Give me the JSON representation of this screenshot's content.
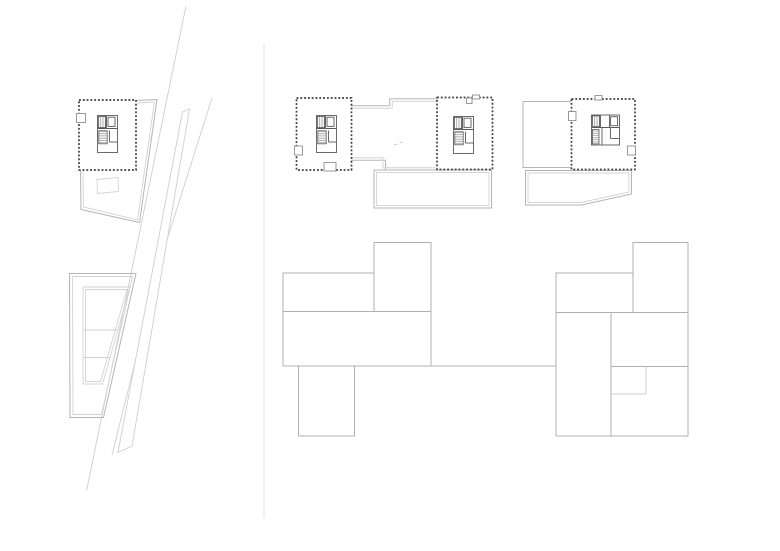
{
  "colors": {
    "background": "#ffffff",
    "wall": "#3f3f3f",
    "core": "#5a5a5a",
    "hatch": "#8a8a8a",
    "outline": "#b5b5b5",
    "outline_light": "#d3d3d3",
    "massing": "#b0b0b0",
    "massing_light": "#cccccc",
    "faint": "#cfcfcf",
    "divider": "#e3e3e3",
    "door": "#8f8f8f"
  },
  "massing": {
    "left_block_plan": {
      "rects": [
        {
          "x": 374,
          "y": 242.5,
          "w": 57,
          "h": 69,
          "name": "block-top-right"
        },
        {
          "x": 283,
          "y": 273,
          "w": 91,
          "h": 38.5,
          "name": "block-upper-left"
        },
        {
          "x": 283,
          "y": 311.5,
          "w": 148,
          "h": 54.5,
          "name": "block-middle-bar"
        },
        {
          "x": 298.5,
          "y": 366,
          "w": 56,
          "h": 70,
          "name": "block-bottom-wing"
        }
      ],
      "lines": [
        {
          "x1": 431,
          "y1": 366,
          "x2": 556,
          "y2": 366,
          "name": "link-line"
        }
      ]
    },
    "right_block_plan": {
      "rects": [
        {
          "x": 633,
          "y": 242.5,
          "w": 55,
          "h": 70,
          "name": "block-top-right"
        },
        {
          "x": 556,
          "y": 273,
          "w": 77,
          "h": 39.5,
          "name": "block-upper-left"
        },
        {
          "x": 556,
          "y": 312.5,
          "w": 55,
          "h": 123.5,
          "name": "block-left-column"
        },
        {
          "x": 611,
          "y": 312.5,
          "w": 77,
          "h": 54,
          "name": "block-right-upper"
        },
        {
          "x": 611,
          "y": 366.5,
          "w": 77,
          "h": 69.5,
          "name": "block-right-lower"
        }
      ],
      "lines": [
        {
          "x1": 646,
          "y1": 366.5,
          "x2": 646,
          "y2": 394,
          "light": true,
          "name": "inner-step"
        },
        {
          "x1": 611,
          "y1": 394,
          "x2": 646,
          "y2": 394,
          "light": true,
          "name": "inner-step"
        }
      ]
    }
  }
}
